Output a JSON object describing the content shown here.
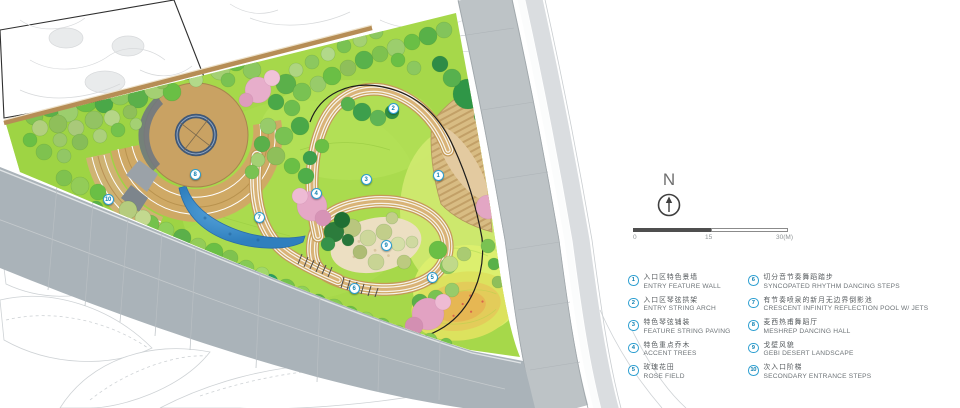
{
  "north": {
    "label": "N"
  },
  "scalebar": {
    "zero": "0",
    "mid": "15",
    "end": "30(M)"
  },
  "legend": {
    "items": [
      {
        "num": "1",
        "zh": "入口区特色景墙",
        "en": "ENTRY FEATURE WALL"
      },
      {
        "num": "2",
        "zh": "入口区琴弦拱架",
        "en": "ENTRY STRING ARCH"
      },
      {
        "num": "3",
        "zh": "特色琴弦铺装",
        "en": "FEATURE STRING PAVING"
      },
      {
        "num": "4",
        "zh": "特色重点乔木",
        "en": "ACCENT TREES"
      },
      {
        "num": "5",
        "zh": "玫瑰花田",
        "en": "ROSE FIELD"
      },
      {
        "num": "6",
        "zh": "切分音节奏舞蹈踏步",
        "en": "SYNCOPATED RHYTHM DANCING STEPS"
      },
      {
        "num": "7",
        "zh": "有节奏喷泉的新月无边界倒影池",
        "en": "CRESCENT INFINITY REFLECTION POOL W/ JETS"
      },
      {
        "num": "8",
        "zh": "麦西热甫舞蹈厅",
        "en": "MESHREP DANCING HALL"
      },
      {
        "num": "9",
        "zh": "戈壁风貌",
        "en": "GEBI DESERT LANDSCAPE"
      },
      {
        "num": "10",
        "zh": "次入口阶梯",
        "en": "SECONDARY ENTRANCE STEPS"
      }
    ]
  },
  "plan": {
    "callouts": [
      {
        "n": "1",
        "x": 438,
        "y": 175
      },
      {
        "n": "2",
        "x": 393,
        "y": 108
      },
      {
        "n": "3",
        "x": 366,
        "y": 179
      },
      {
        "n": "4",
        "x": 316,
        "y": 193
      },
      {
        "n": "5",
        "x": 432,
        "y": 277
      },
      {
        "n": "6",
        "x": 354,
        "y": 288
      },
      {
        "n": "7",
        "x": 259,
        "y": 217
      },
      {
        "n": "8",
        "x": 195,
        "y": 174
      },
      {
        "n": "9",
        "x": 386,
        "y": 245
      },
      {
        "n": "10",
        "x": 108,
        "y": 199
      }
    ]
  },
  "colors": {
    "legend_accent": "#2d9fd1",
    "pool_blue": "#3f8fcb",
    "path_tan": "#c9a263",
    "lawn_green": "#a6d84a",
    "road_gray": "#aab3b9",
    "accent_tree_pink": "#e2a2c2"
  }
}
